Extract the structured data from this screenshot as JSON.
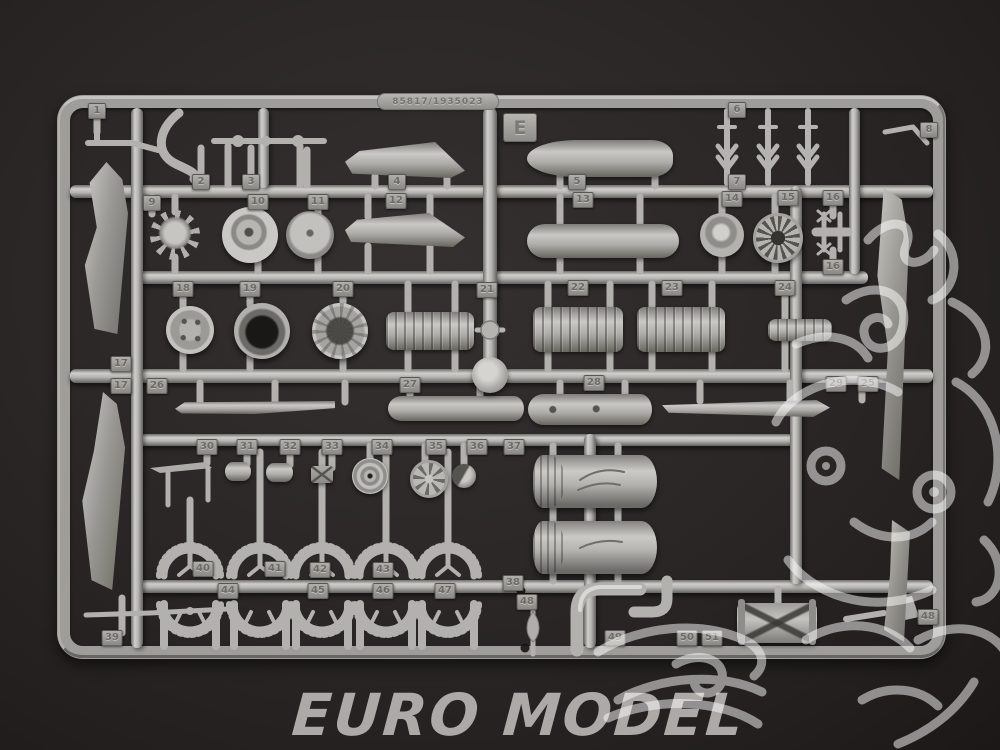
{
  "photo": {
    "subject": "Gray plastic model-kit sprue (runner E) photographed on a dark charcoal background",
    "sprue_letter": "E",
    "mold_number": "85817/1935023"
  },
  "watermark": {
    "shop_text": "EURO MODEL"
  },
  "colors": {
    "background": "#2a2726",
    "plastic": "#a9a8a4",
    "plastic_highlight": "#d3d2ce",
    "plastic_shadow": "#67665f",
    "watermark_line": "#ffffff",
    "watermark_text": "#b4b1af"
  },
  "part_tags": [
    {
      "label": "1",
      "x": 97,
      "y": 111
    },
    {
      "label": "2",
      "x": 201,
      "y": 182
    },
    {
      "label": "3",
      "x": 251,
      "y": 182
    },
    {
      "label": "4",
      "x": 397,
      "y": 182
    },
    {
      "label": "5",
      "x": 577,
      "y": 182
    },
    {
      "label": "6",
      "x": 737,
      "y": 110
    },
    {
      "label": "7",
      "x": 737,
      "y": 182
    },
    {
      "label": "8",
      "x": 929,
      "y": 130
    },
    {
      "label": "9",
      "x": 152,
      "y": 203
    },
    {
      "label": "10",
      "x": 258,
      "y": 202
    },
    {
      "label": "11",
      "x": 318,
      "y": 202
    },
    {
      "label": "12",
      "x": 396,
      "y": 201
    },
    {
      "label": "13",
      "x": 583,
      "y": 200
    },
    {
      "label": "14",
      "x": 732,
      "y": 199
    },
    {
      "label": "15",
      "x": 788,
      "y": 198
    },
    {
      "label": "16",
      "x": 833,
      "y": 198
    },
    {
      "label": "16",
      "x": 833,
      "y": 267
    },
    {
      "label": "17",
      "x": 121,
      "y": 364
    },
    {
      "label": "17",
      "x": 121,
      "y": 386
    },
    {
      "label": "18",
      "x": 183,
      "y": 289
    },
    {
      "label": "19",
      "x": 250,
      "y": 289
    },
    {
      "label": "20",
      "x": 343,
      "y": 289
    },
    {
      "label": "21",
      "x": 487,
      "y": 290
    },
    {
      "label": "22",
      "x": 578,
      "y": 288
    },
    {
      "label": "23",
      "x": 672,
      "y": 288
    },
    {
      "label": "24",
      "x": 785,
      "y": 288
    },
    {
      "label": "25",
      "x": 868,
      "y": 384
    },
    {
      "label": "29",
      "x": 836,
      "y": 384
    },
    {
      "label": "26",
      "x": 157,
      "y": 386
    },
    {
      "label": "27",
      "x": 410,
      "y": 385
    },
    {
      "label": "28",
      "x": 594,
      "y": 383
    },
    {
      "label": "30",
      "x": 207,
      "y": 447
    },
    {
      "label": "31",
      "x": 247,
      "y": 447
    },
    {
      "label": "32",
      "x": 290,
      "y": 447
    },
    {
      "label": "33",
      "x": 332,
      "y": 447
    },
    {
      "label": "34",
      "x": 382,
      "y": 447
    },
    {
      "label": "35",
      "x": 436,
      "y": 447
    },
    {
      "label": "36",
      "x": 477,
      "y": 447
    },
    {
      "label": "37",
      "x": 514,
      "y": 447
    },
    {
      "label": "38",
      "x": 513,
      "y": 583
    },
    {
      "label": "39",
      "x": 112,
      "y": 638
    },
    {
      "label": "40",
      "x": 203,
      "y": 569
    },
    {
      "label": "41",
      "x": 275,
      "y": 569
    },
    {
      "label": "42",
      "x": 320,
      "y": 570
    },
    {
      "label": "43",
      "x": 383,
      "y": 570
    },
    {
      "label": "44",
      "x": 228,
      "y": 591
    },
    {
      "label": "45",
      "x": 318,
      "y": 591
    },
    {
      "label": "46",
      "x": 383,
      "y": 591
    },
    {
      "label": "47",
      "x": 445,
      "y": 591
    },
    {
      "label": "48",
      "x": 527,
      "y": 602
    },
    {
      "label": "48",
      "x": 928,
      "y": 617
    },
    {
      "label": "49",
      "x": 615,
      "y": 638
    },
    {
      "label": "50",
      "x": 687,
      "y": 638
    },
    {
      "label": "51",
      "x": 712,
      "y": 638
    }
  ]
}
